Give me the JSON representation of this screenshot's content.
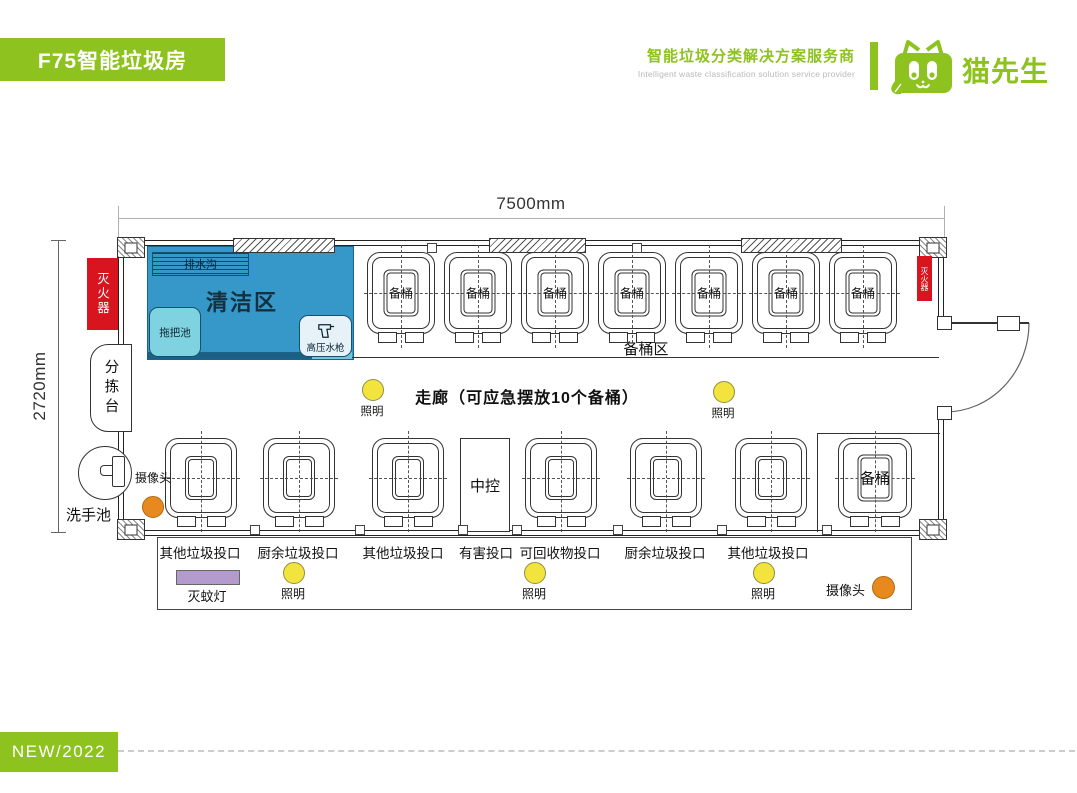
{
  "header": {
    "badge": "F75智能垃圾房",
    "tagline_zh": "智能垃圾分类解决方案服务商",
    "tagline_en": "Intelligent waste classification solution service provider",
    "brand": "猫先生"
  },
  "dimensions": {
    "width_label": "7500mm",
    "height_label": "2720mm"
  },
  "rooms": {
    "cleaning_area": "清洁区",
    "drain": "排水沟",
    "mop_pool": "拖把池",
    "pressure_gun": "高压水枪",
    "spare_bin_zone": "备桶区",
    "corridor": "走廊（可应急摆放10个备桶）",
    "central_control": "中控"
  },
  "equipment": {
    "fire_extinguisher": "灭火器",
    "sorting_table": "分拣台",
    "wash_basin": "洗手池",
    "camera": "摄像头",
    "lighting": "照明",
    "mosquito_lamp": "灭蚊灯",
    "spare_bin": "备桶"
  },
  "top_bins": [
    "备桶",
    "备桶",
    "备桶",
    "备桶",
    "备桶",
    "备桶",
    "备桶"
  ],
  "inlets": [
    "其他垃圾投口",
    "厨余垃圾投口",
    "其他垃圾投口",
    "有害投口",
    "可回收物投口",
    "厨余垃圾投口",
    "其他垃圾投口"
  ],
  "footer": {
    "badge": "NEW/2022"
  },
  "colors": {
    "brand_green": "#8dc21f",
    "cleaning_blue": "#3598c8",
    "mop_blue": "#7fd2e0",
    "alert_red": "#d8141e",
    "light_yellow": "#f2e43c",
    "camera_orange": "#e8891f",
    "lamp_purple": "#b49bce"
  }
}
